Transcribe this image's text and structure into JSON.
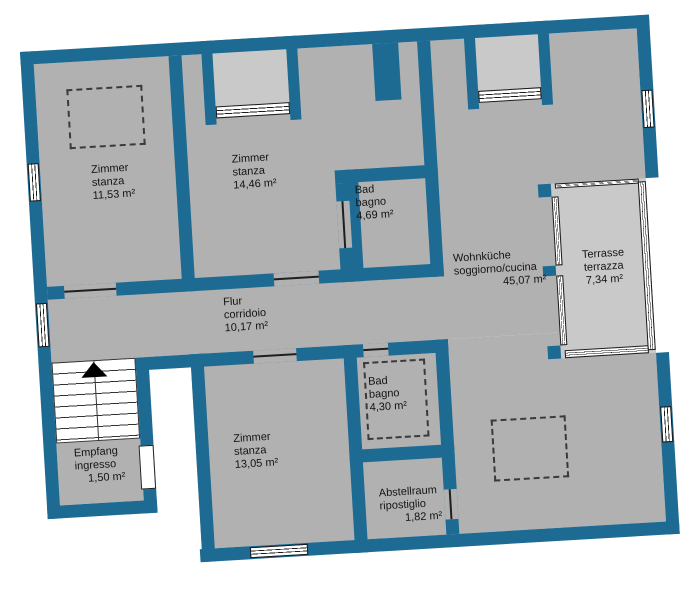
{
  "plan_title": "floor-plan",
  "colors": {
    "wall": "#1d6a93",
    "room": "#b1b1b1",
    "outdoor": "#c9c9c9",
    "line": "#1a1a1a"
  },
  "rooms": [
    {
      "id": "zimmer1",
      "name_de": "Zimmer",
      "name_it": "stanza",
      "area": "11,53 m²"
    },
    {
      "id": "zimmer2",
      "name_de": "Zimmer",
      "name_it": "stanza",
      "area": "14,46 m²"
    },
    {
      "id": "bad1",
      "name_de": "Bad",
      "name_it": "bagno",
      "area": "4,69 m²"
    },
    {
      "id": "wohnkueche",
      "name_de": "Wohnküche",
      "name_it": "soggiorno/cucina",
      "area": "45,07 m²"
    },
    {
      "id": "terrasse",
      "name_de": "Terrasse",
      "name_it": "terrazza",
      "area": "7,34 m²"
    },
    {
      "id": "flur",
      "name_de": "Flur",
      "name_it": "corridoio",
      "area": "10,17 m²"
    },
    {
      "id": "empfang",
      "name_de": "Empfang",
      "name_it": "ingresso",
      "area": "1,50 m²"
    },
    {
      "id": "zimmer3",
      "name_de": "Zimmer",
      "name_it": "stanza",
      "area": "13,05 m²"
    },
    {
      "id": "bad2",
      "name_de": "Bad",
      "name_it": "bagno",
      "area": "4,30 m²"
    },
    {
      "id": "abstellraum",
      "name_de": "Abstellraum",
      "name_it": "ripostiglio",
      "area": "1,82 m²"
    }
  ]
}
